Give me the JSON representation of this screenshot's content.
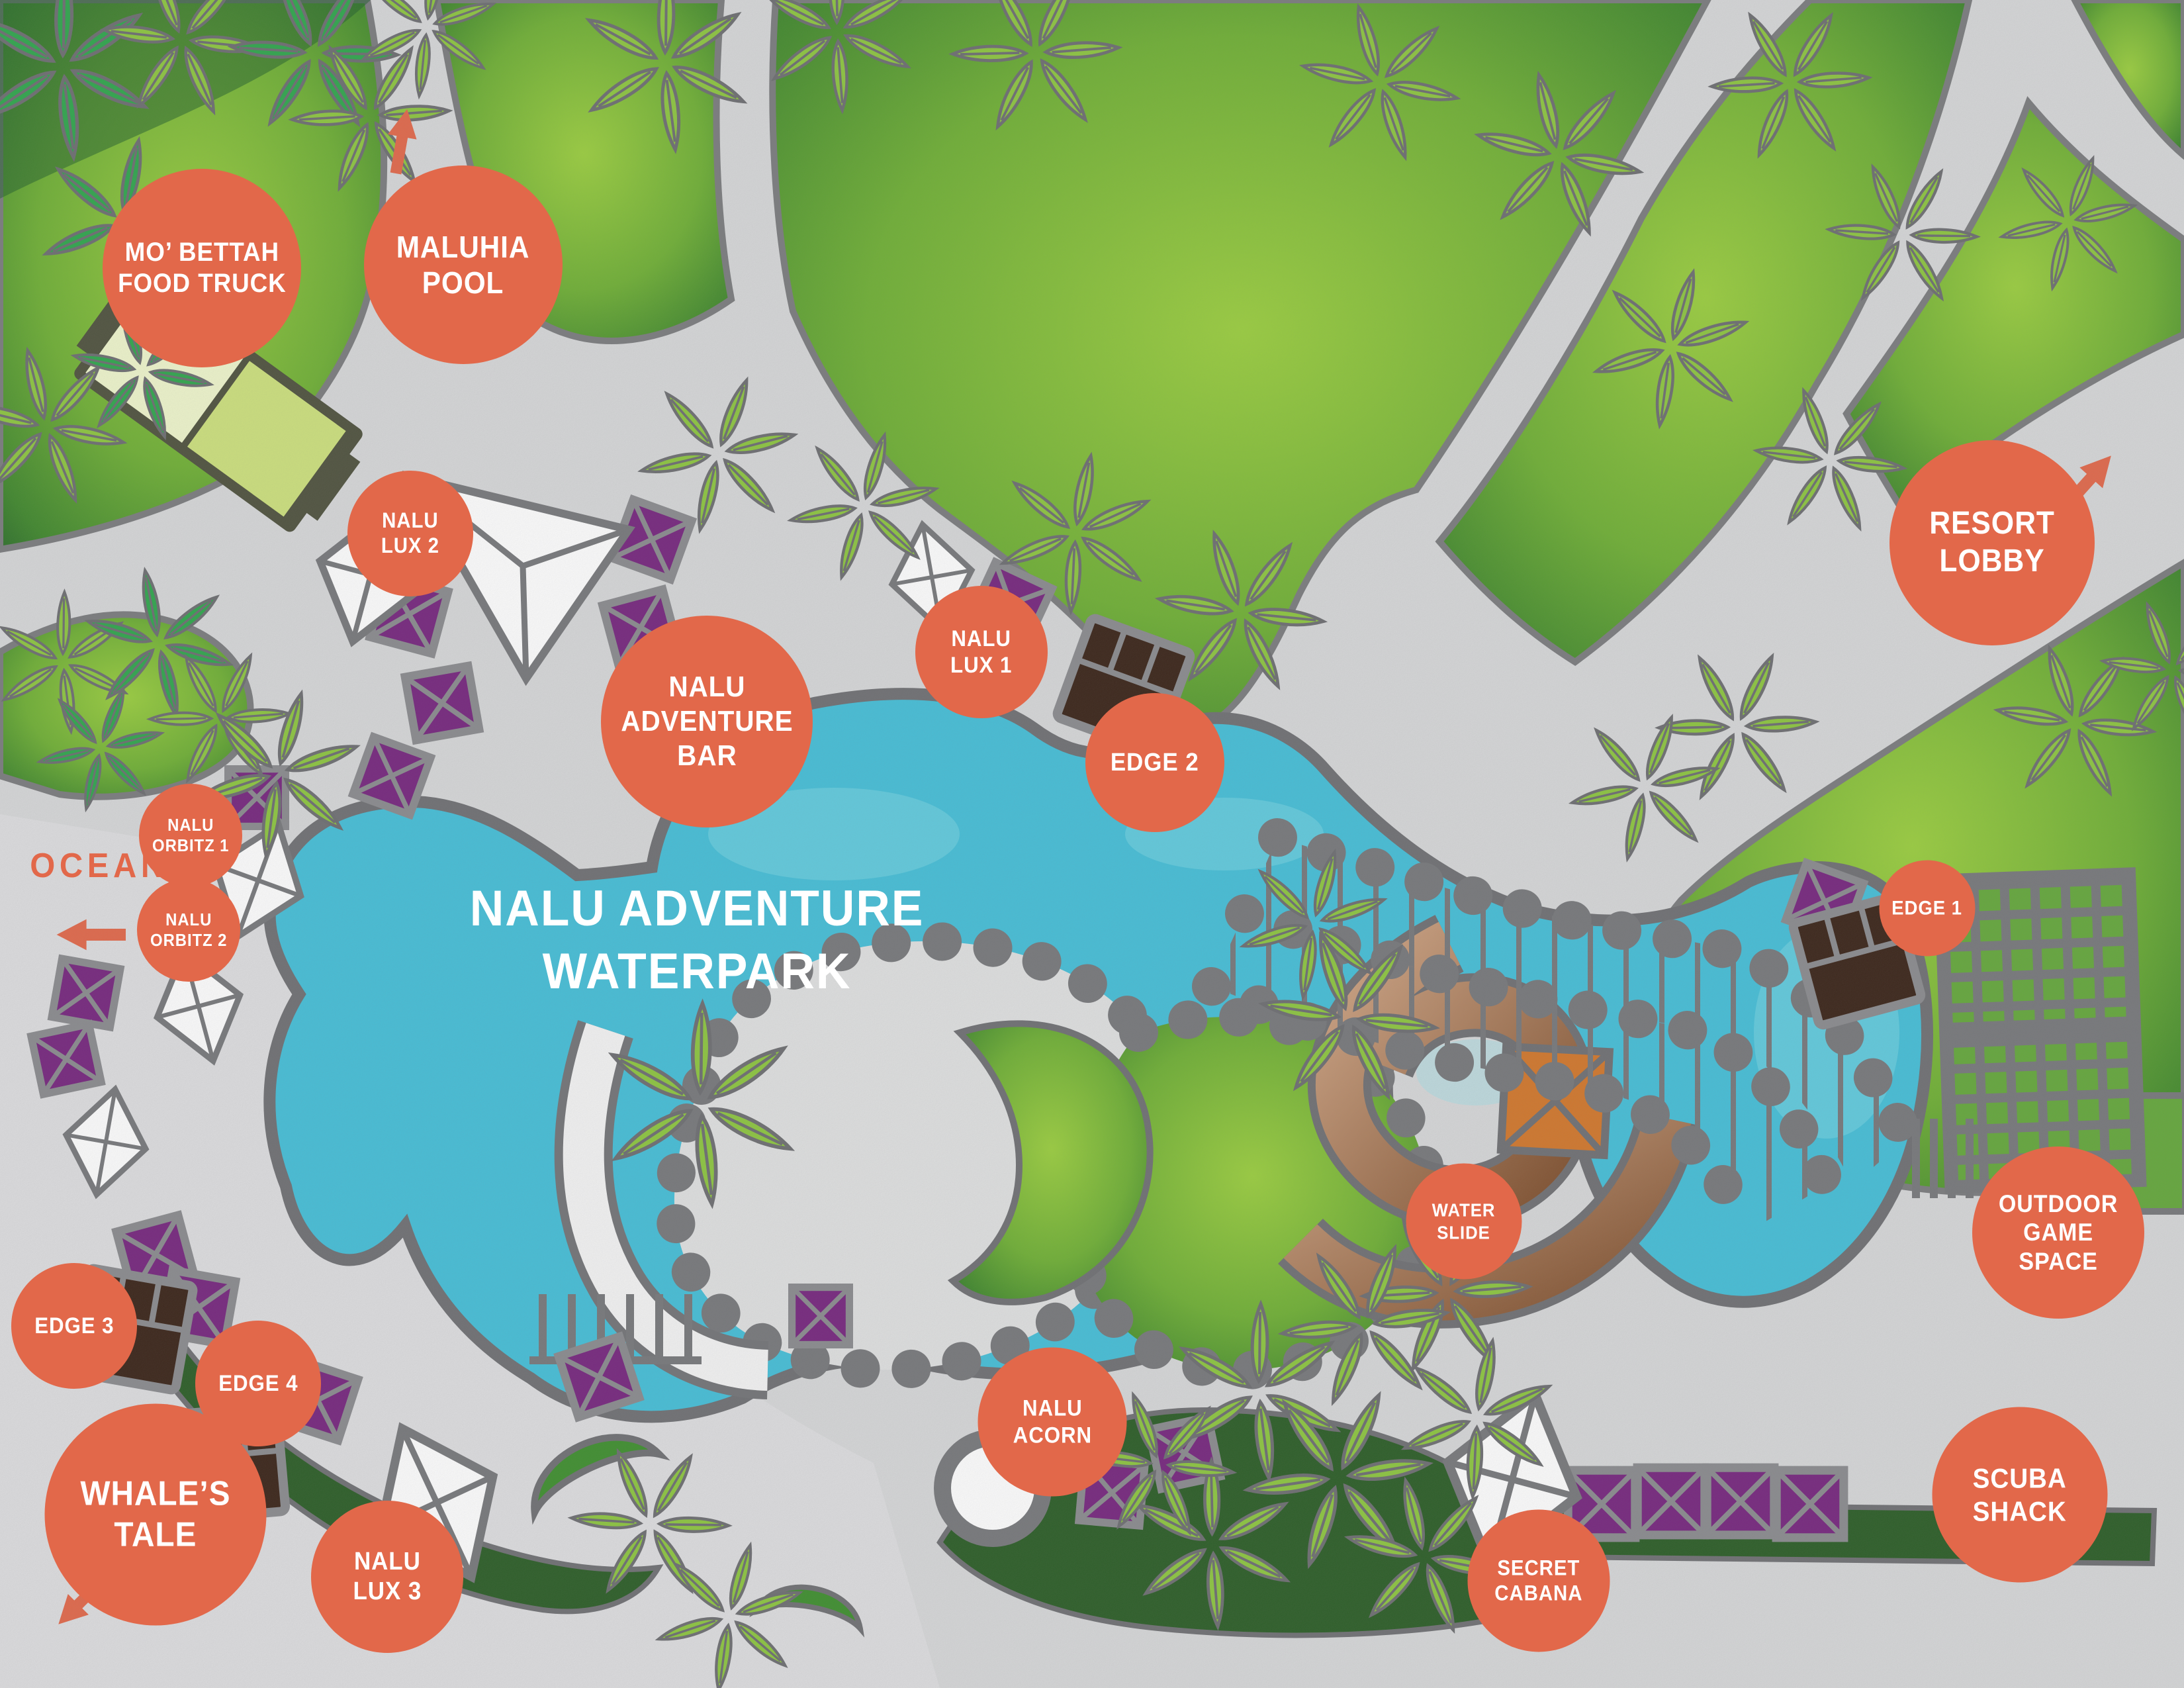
{
  "map": {
    "title": "NALU ADVENTURE\nWATERPARK",
    "ocean": "OCEAN",
    "colors": {
      "label_orange": "#e2684a",
      "pool_blue": "#45bfd8",
      "lawn_green": "#7dbd36",
      "hedge_green": "#2b5d26",
      "umbrella_purple": "#76267e",
      "deck_gray": "#d7d8d9",
      "outline_gray": "#7b7c7e",
      "slide_brown": "#a9764f",
      "tower_orange": "#d2772b"
    },
    "labels": [
      {
        "id": "mo-bettah-food-truck",
        "text": "MO’ BETTAH\nFOOD TRUCK"
      },
      {
        "id": "maluhia-pool",
        "text": "MALUHIA\nPOOL"
      },
      {
        "id": "nalu-lux-2",
        "text": "NALU\nLUX 2"
      },
      {
        "id": "nalu-adventure-bar",
        "text": "NALU\nADVENTURE\nBAR"
      },
      {
        "id": "nalu-lux-1",
        "text": "NALU\nLUX 1"
      },
      {
        "id": "edge-2",
        "text": "EDGE 2"
      },
      {
        "id": "resort-lobby",
        "text": "RESORT\nLOBBY"
      },
      {
        "id": "nalu-orbitz-1",
        "text": "NALU\nORBITZ 1"
      },
      {
        "id": "nalu-orbitz-2",
        "text": "NALU\nORBITZ 2"
      },
      {
        "id": "edge-1",
        "text": "EDGE 1"
      },
      {
        "id": "outdoor-game-space",
        "text": "OUTDOOR\nGAME\nSPACE"
      },
      {
        "id": "water-slide",
        "text": "WATER\nSLIDE"
      },
      {
        "id": "edge-3",
        "text": "EDGE 3"
      },
      {
        "id": "edge-4",
        "text": "EDGE 4"
      },
      {
        "id": "whales-tale",
        "text": "WHALE’S\nTALE"
      },
      {
        "id": "nalu-lux-3",
        "text": "NALU\nLUX 3"
      },
      {
        "id": "nalu-acorn",
        "text": "NALU\nACORN"
      },
      {
        "id": "secret-cabana",
        "text": "SECRET\nCABANA"
      },
      {
        "id": "scuba-shack",
        "text": "SCUBA\nSHACK"
      }
    ]
  }
}
